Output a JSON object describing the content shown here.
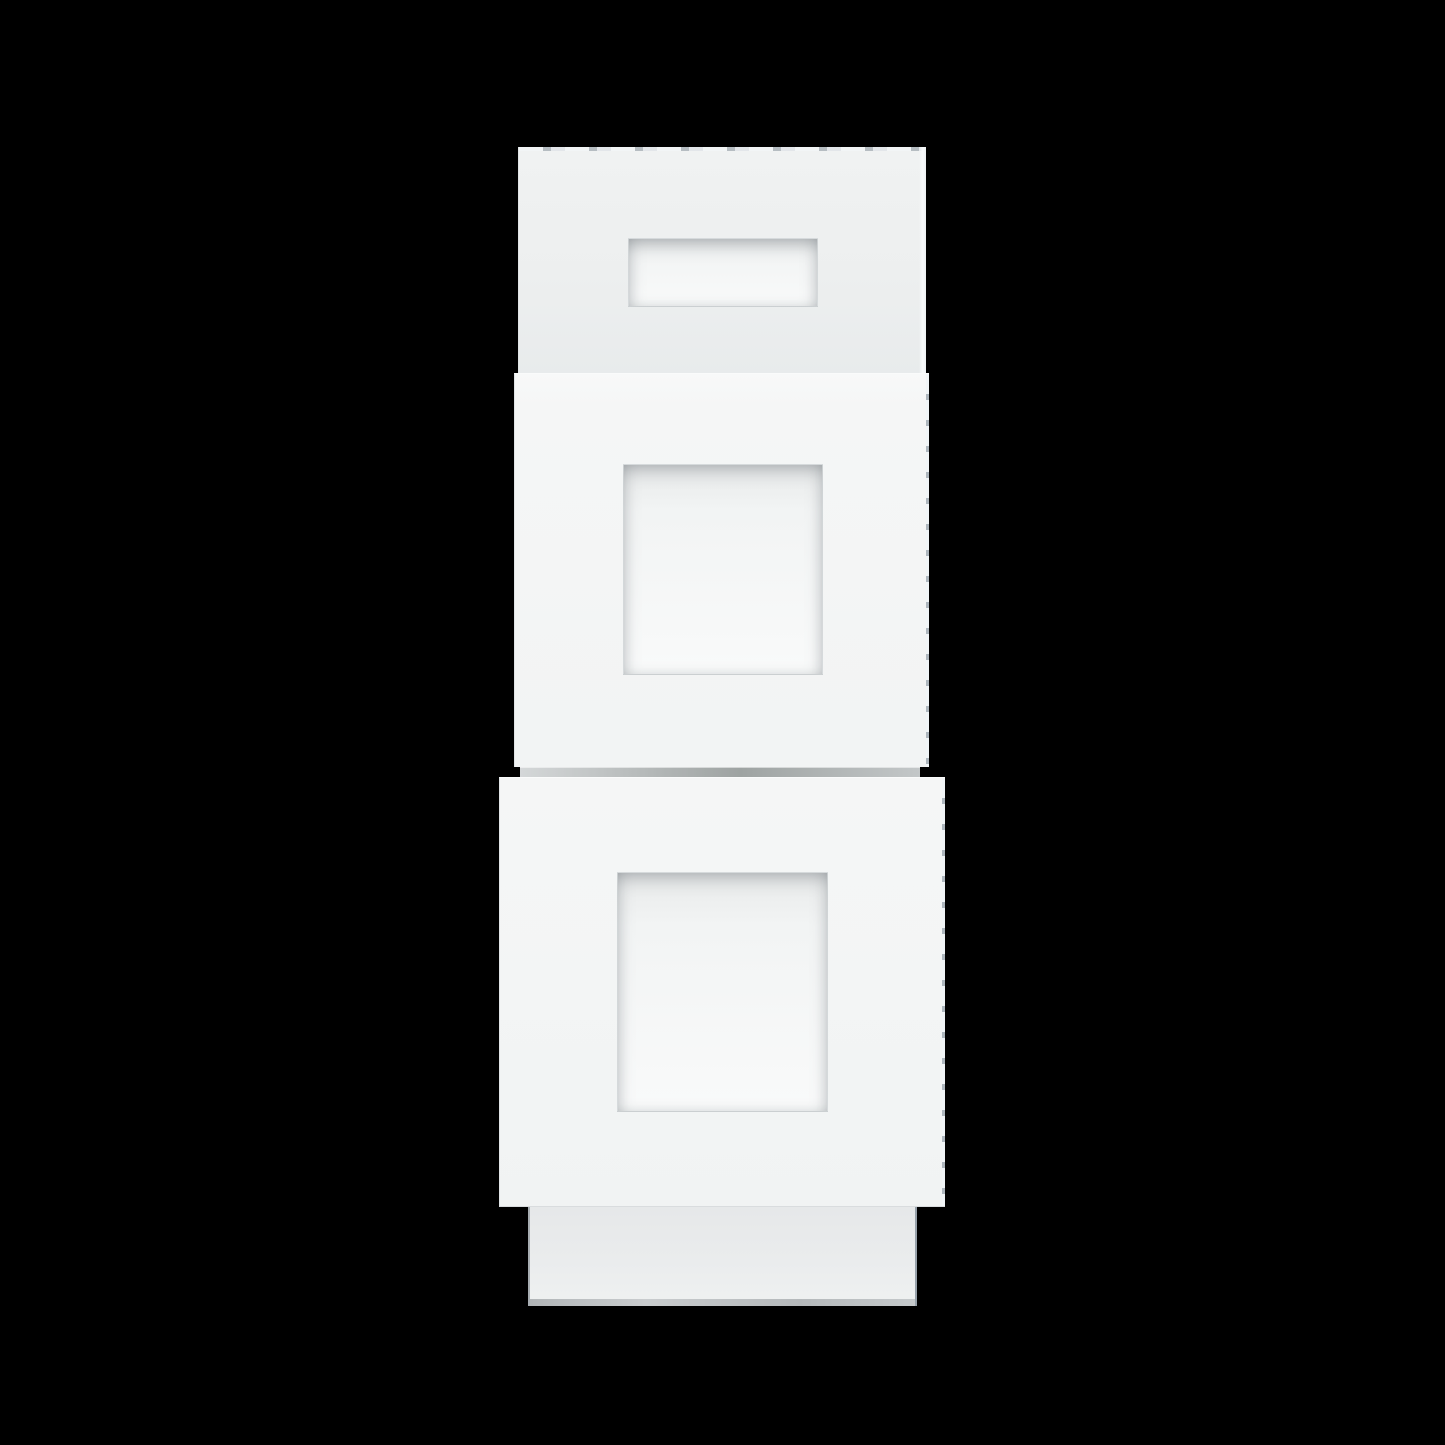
{
  "scene": {
    "object": "three-drawer base cabinet",
    "style": "shaker recessed-panel drawer fronts",
    "finish": "white",
    "background": "solid black",
    "visible_text": "none"
  },
  "colors": {
    "background": "#000000",
    "face_top_a": "#f0f2f2",
    "face_top_b": "#e8ebec",
    "face_mid_a": "#f8f9f9",
    "face_mid_b": "#f2f4f4",
    "face_bot_a": "#f5f6f6",
    "face_bot_b": "#f1f3f3",
    "recess_a": "#e8eaea",
    "recess_b": "#f2f4f4",
    "recess_c": "#f9fafa",
    "rail_a": "#d4d7d8",
    "rail_b": "#9ea3a2",
    "rail_c": "#c3c7c8",
    "toe_a": "#e6e8e9",
    "toe_b": "#eff1f1",
    "toe_edge": "#b2b6b8",
    "edge_hairline": "#e0e4e6",
    "edge_highlight": "#fafbfb",
    "edge_dash_dark": "#b3bac0"
  },
  "parts": {
    "toe_kick": {
      "left": 528,
      "top": 1207,
      "width": 389,
      "height": 99
    },
    "cabinet_rail": {
      "left": 520,
      "top": 767,
      "width": 400,
      "height": 10
    },
    "top_drawer": {
      "left": 518,
      "top": 147,
      "width": 408,
      "height": 230
    },
    "top_drawer_recess": {
      "left": 628,
      "top": 238,
      "width": 190,
      "height": 69
    },
    "middle_drawer": {
      "left": 514,
      "top": 373,
      "width": 415,
      "height": 394
    },
    "middle_drawer_recess": {
      "left": 623,
      "top": 464,
      "width": 200,
      "height": 211
    },
    "bottom_drawer": {
      "left": 499,
      "top": 777,
      "width": 446,
      "height": 430
    },
    "bottom_drawer_recess": {
      "left": 617,
      "top": 872,
      "width": 211,
      "height": 240
    }
  }
}
